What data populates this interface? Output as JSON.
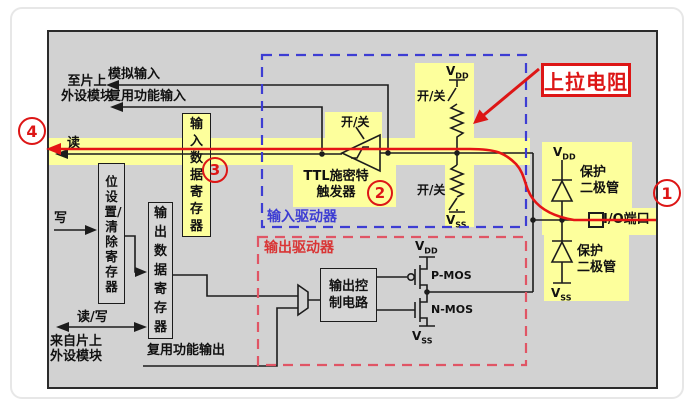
{
  "colors": {
    "panel_bg": "#d2d2d2",
    "highlight_yellow": "#fdff9c",
    "wire_black": "#1c1c1c",
    "read_path_red": "#e51515",
    "input_driver_blue": "#3d3dd3",
    "output_driver_red": "#e05565",
    "annotation_red": "#dd1616"
  },
  "labels": {
    "to_chip_l1": "至片上",
    "to_chip_l2": "外设模块",
    "analog_input": "模拟输入",
    "af_input": "复用功能输入",
    "read": "读",
    "write": "写",
    "read_write": "读/写",
    "from_chip_l1": "来自片上",
    "from_chip_l2": "外设模块",
    "af_output": "复用功能输出",
    "input_data_reg": "输入数据寄存器",
    "bit_set_reset_reg": "位设置/清除寄存器",
    "output_data_reg": "输出数据寄存器",
    "ttl_l1": "TTL施密特",
    "ttl_l2": "触发器",
    "output_control": "输出控制电路",
    "input_driver": "输入驱动器",
    "output_driver": "输出驱动器",
    "on_off": "开/关",
    "pullup_annotation": "上拉电阻",
    "protect_l1": "保护",
    "protect_l2": "二极管",
    "io_port": "I/O端口",
    "pmos": "P-MOS",
    "nmos": "N-MOS",
    "v": "V",
    "dd": "DD",
    "ss": "SS"
  },
  "numbers": {
    "one": "1",
    "two": "2",
    "three": "3",
    "four": "4"
  }
}
